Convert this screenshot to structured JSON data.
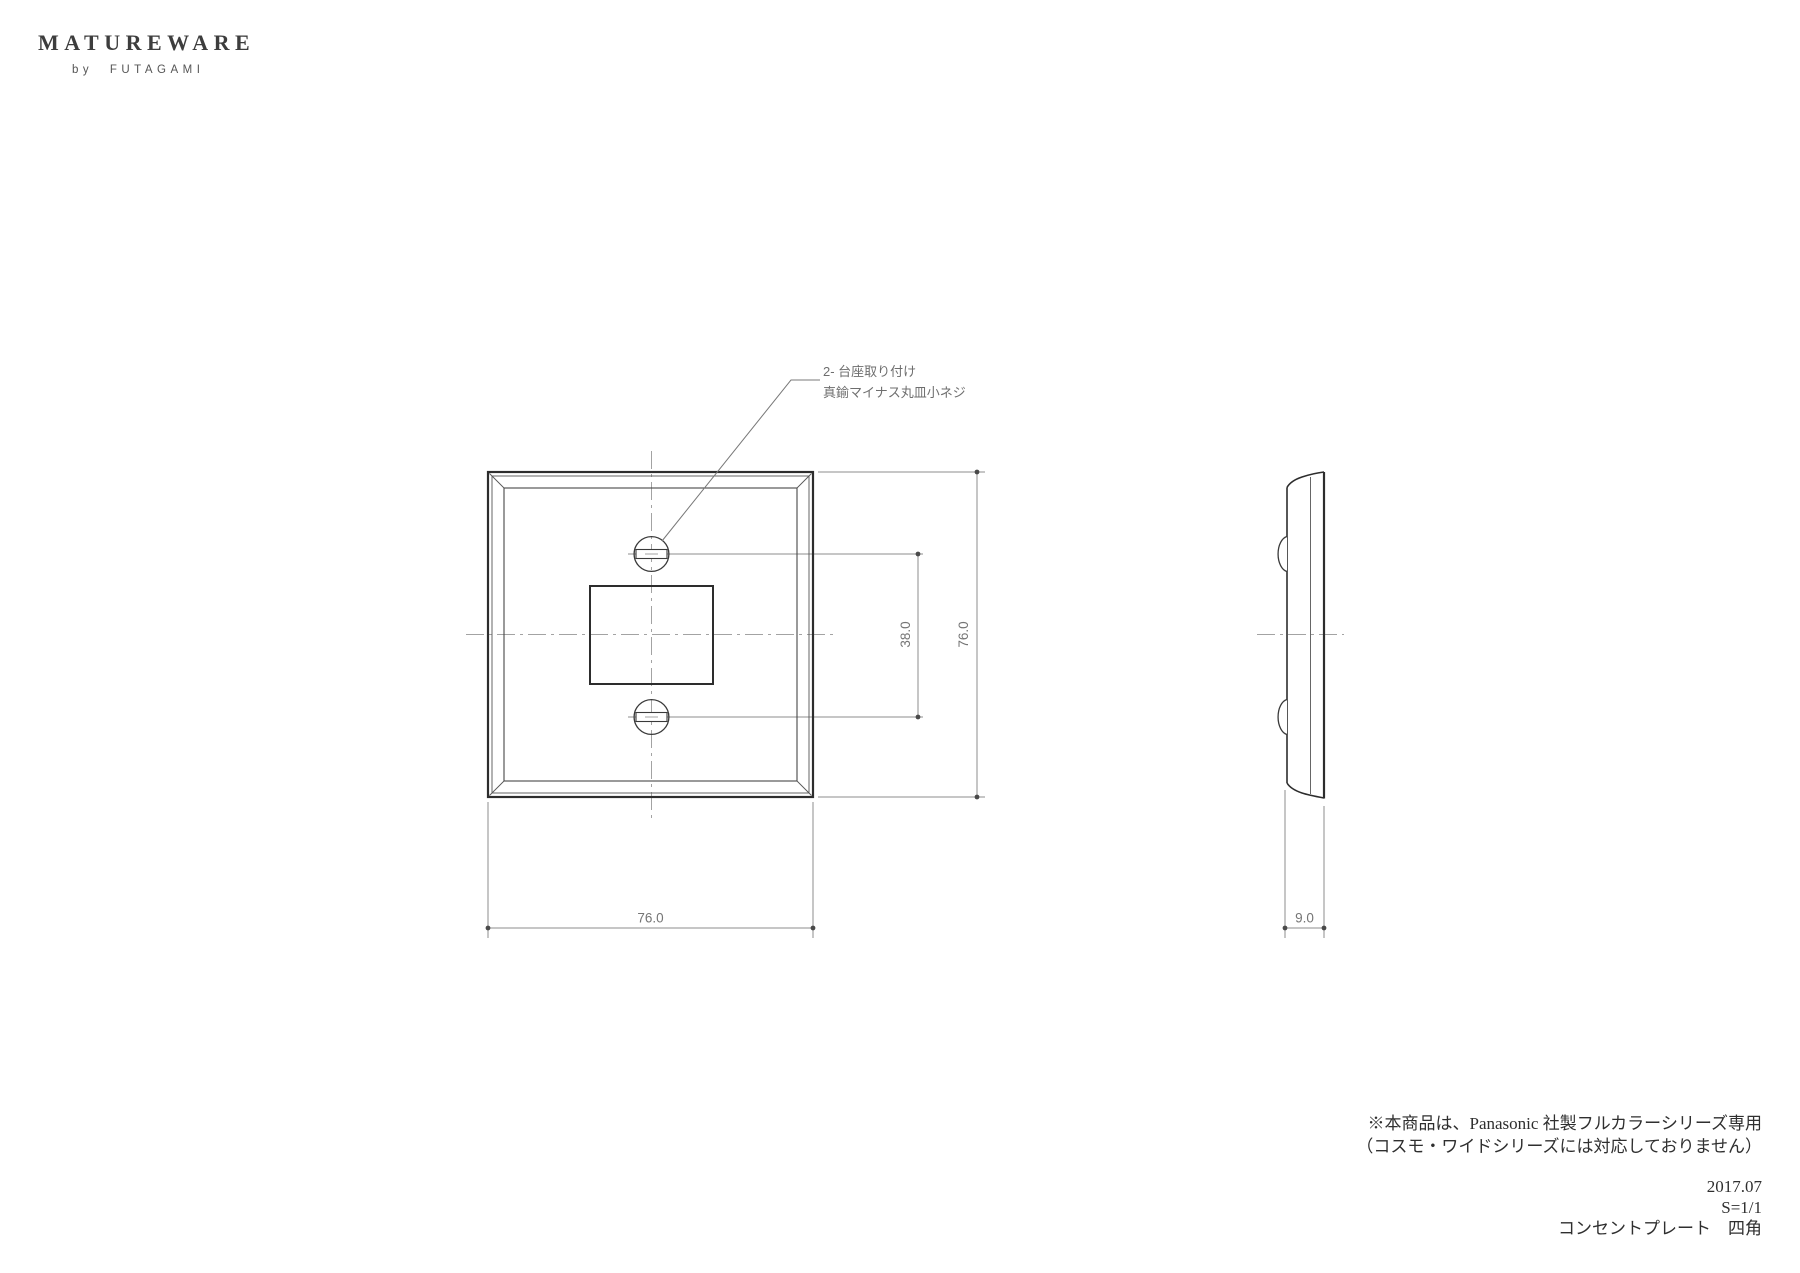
{
  "brand": {
    "logo": "MATUREWARE",
    "byline": "by FUTAGAMI"
  },
  "annotation": {
    "line1": "2- 台座取り付け",
    "line2": "真鍮マイナス丸皿小ネジ"
  },
  "dimensions": {
    "plate_width": "76.0",
    "plate_height": "76.0",
    "screw_pitch": "38.0",
    "depth": "9.0"
  },
  "footnote": {
    "line1": "※本商品は、Panasonic 社製フルカラーシリーズ専用",
    "line2": "（コスモ・ワイドシリーズには対応しておりません）"
  },
  "title_block": {
    "date": "2017.07",
    "scale": "S=1/1",
    "product": "コンセントプレート　四角"
  },
  "colors": {
    "outline": "#2d2d2d",
    "thin_line": "#565656",
    "dimension_line": "#8c8c8c",
    "centerline": "#a3a3a3",
    "dimension_text": "#757575",
    "note_text": "#2f2f2f",
    "logo_text": "#3d3d3d",
    "background": "#ffffff"
  }
}
